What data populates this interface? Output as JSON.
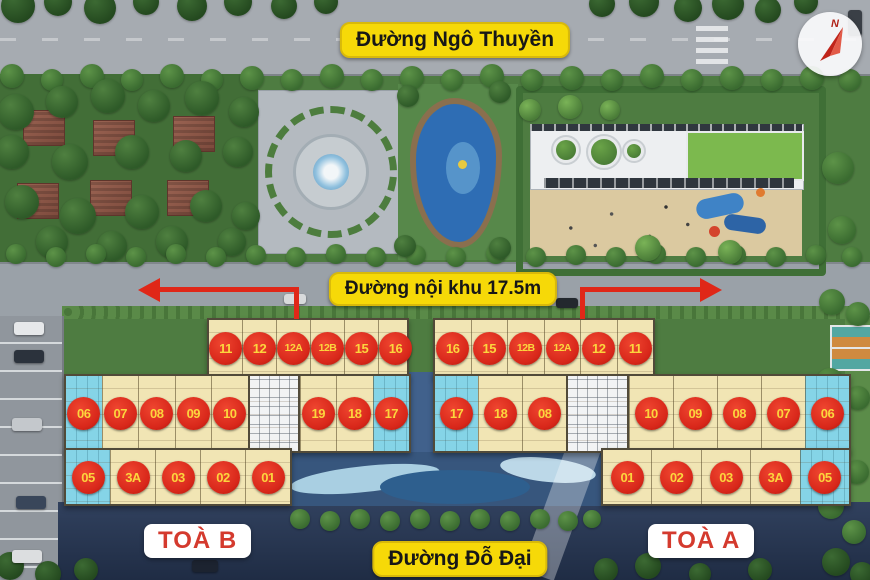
{
  "streets": {
    "top_label": "Đường Ngô Thuyền",
    "internal_label": "Đường nội khu 17.5m",
    "bottom_label": "Đường Đỗ Đại"
  },
  "compass": {
    "north_label": "N"
  },
  "towers": {
    "b": {
      "label": "TOÀ B",
      "top_units": [
        "11",
        "12",
        "12A",
        "12B",
        "15",
        "16"
      ],
      "mid_units": [
        "06",
        "07",
        "08",
        "09",
        "10",
        null,
        "19",
        "18",
        "17"
      ],
      "bottom_units": [
        "05",
        "3A",
        "03",
        "02",
        "01"
      ]
    },
    "a": {
      "label": "TOÀ A",
      "top_units": [
        "16",
        "15",
        "12B",
        "12A",
        "12",
        "11"
      ],
      "mid_units": [
        "17",
        "18",
        "08",
        null,
        "10",
        "09",
        "08",
        "07",
        "06"
      ],
      "bottom_units": [
        "01",
        "02",
        "03",
        "3A",
        "05"
      ]
    }
  },
  "colors": {
    "badge_yellow": "#f6d908",
    "badge_text": "#171717",
    "unit_circle_red": "#d8271a",
    "unit_circle_text": "#fcd53d",
    "tower_label_red": "#d43a2e",
    "arrow_red": "#e02718",
    "unit_cream": "#f1e5b4",
    "unit_corner_blue": "#85d4e7",
    "pool_blue": "#2e6db4",
    "lawn_green": "#7cb94e",
    "park_green": "#4e7c41",
    "road_gray": "#a6abb1",
    "road_dark": "#2a3a56"
  }
}
